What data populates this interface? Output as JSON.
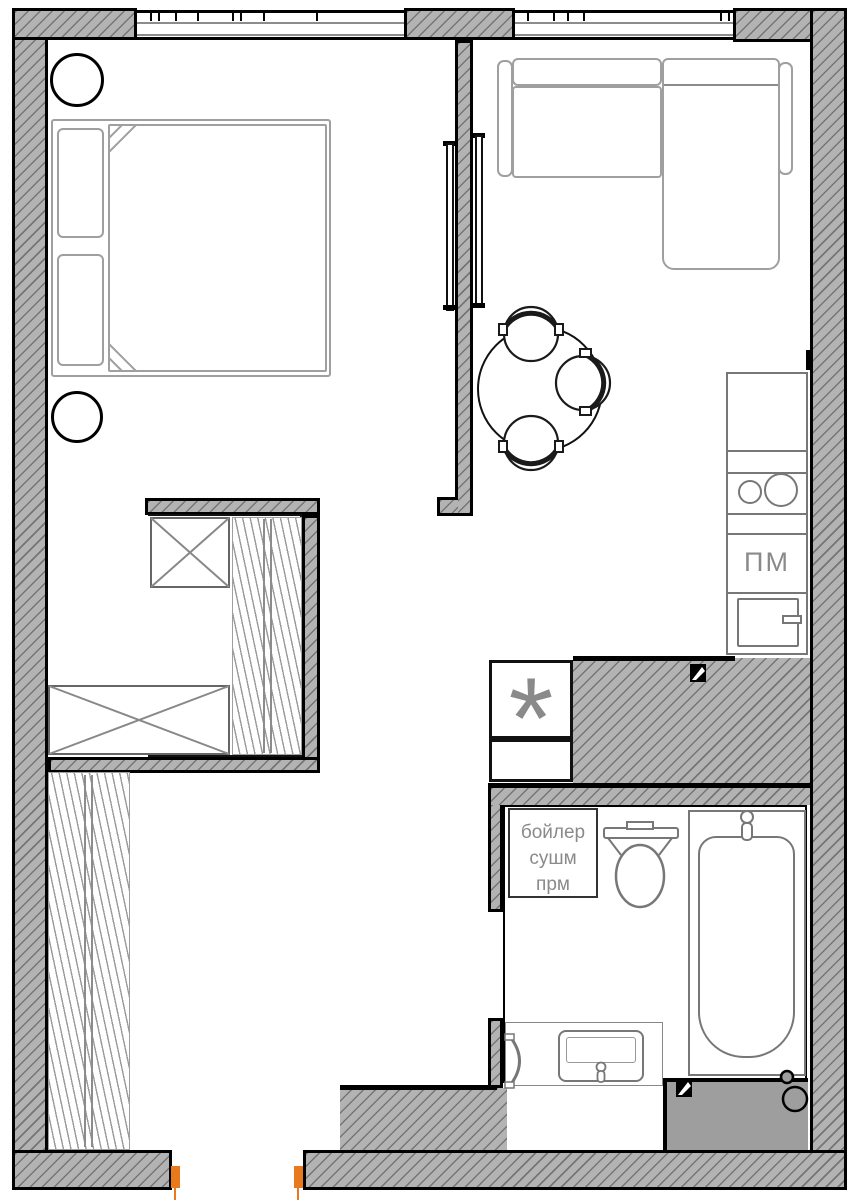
{
  "labels": {
    "dishwasher": "ПМ",
    "utility_symbol": "*",
    "boiler_line1": "бойлер",
    "boiler_line2": "сушм",
    "boiler_line3": "прм"
  },
  "colors": {
    "wall_fill": "#b3b3b3",
    "hatch_line": "#757575",
    "outline": "#000000",
    "furniture_stroke": "#9f9f9f",
    "fixture_stroke": "#777777",
    "label_text": "#8a8a8a",
    "accent_orange": "#e8791d",
    "block_fill": "#9e9e9e"
  }
}
